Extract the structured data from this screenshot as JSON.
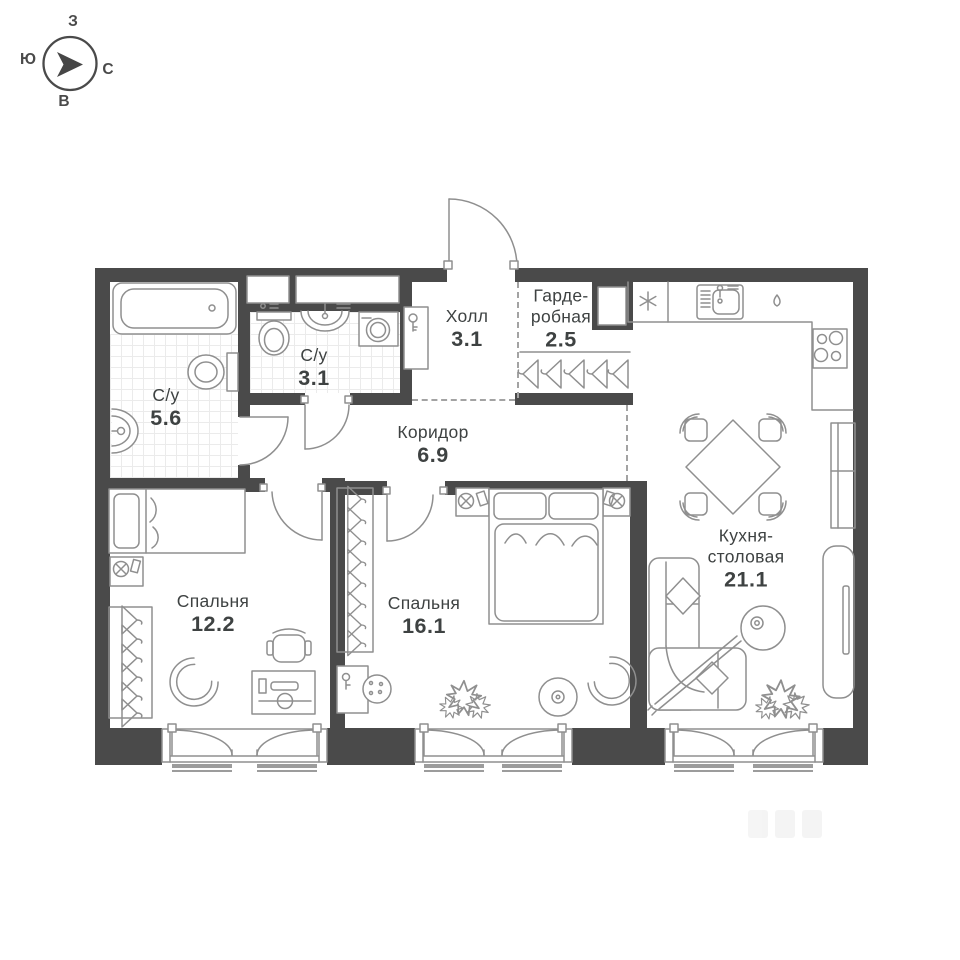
{
  "colors": {
    "wall": "#4a4a4a",
    "line": "#8f8f8f",
    "text": "#3e4242",
    "tile": "#ebebeb"
  },
  "compass": {
    "west": "З",
    "south": "Ю",
    "north": "С",
    "east": "В"
  },
  "rooms": [
    {
      "id": "bathroom-large",
      "name": "С/у",
      "area": "5.6"
    },
    {
      "id": "bathroom-small",
      "name": "С/у",
      "area": "3.1"
    },
    {
      "id": "hall",
      "name": "Холл",
      "area": "3.1"
    },
    {
      "id": "wardrobe",
      "name_line1": "Гарде-",
      "name_line2": "робная",
      "area": "2.5"
    },
    {
      "id": "corridor",
      "name": "Коридор",
      "area": "6.9"
    },
    {
      "id": "bedroom-1",
      "name": "Спальня",
      "area": "12.2"
    },
    {
      "id": "bedroom-2",
      "name": "Спальня",
      "area": "16.1"
    },
    {
      "id": "kitchen-dining",
      "name_line1": "Кухня-",
      "name_line2": "столовая",
      "area": "21.1"
    }
  ],
  "icons": [
    "compass-icon",
    "bathtub-icon",
    "toilet-icon",
    "sink-icon",
    "washing-machine-icon",
    "hanger-icon",
    "entrance-door-icon",
    "interior-door-icon",
    "fridge-icon",
    "kitchen-sink-icon",
    "dishwasher-icon",
    "stove-icon",
    "dining-table-icon",
    "dining-chair-icon",
    "sofa-icon",
    "floor-lamp-icon",
    "plant-icon",
    "single-bed-icon",
    "double-bed-icon",
    "nightstand-icon",
    "desk-icon",
    "office-chair-icon",
    "armchair-icon",
    "pouf-icon",
    "window-icon",
    "cabinet-icon"
  ]
}
